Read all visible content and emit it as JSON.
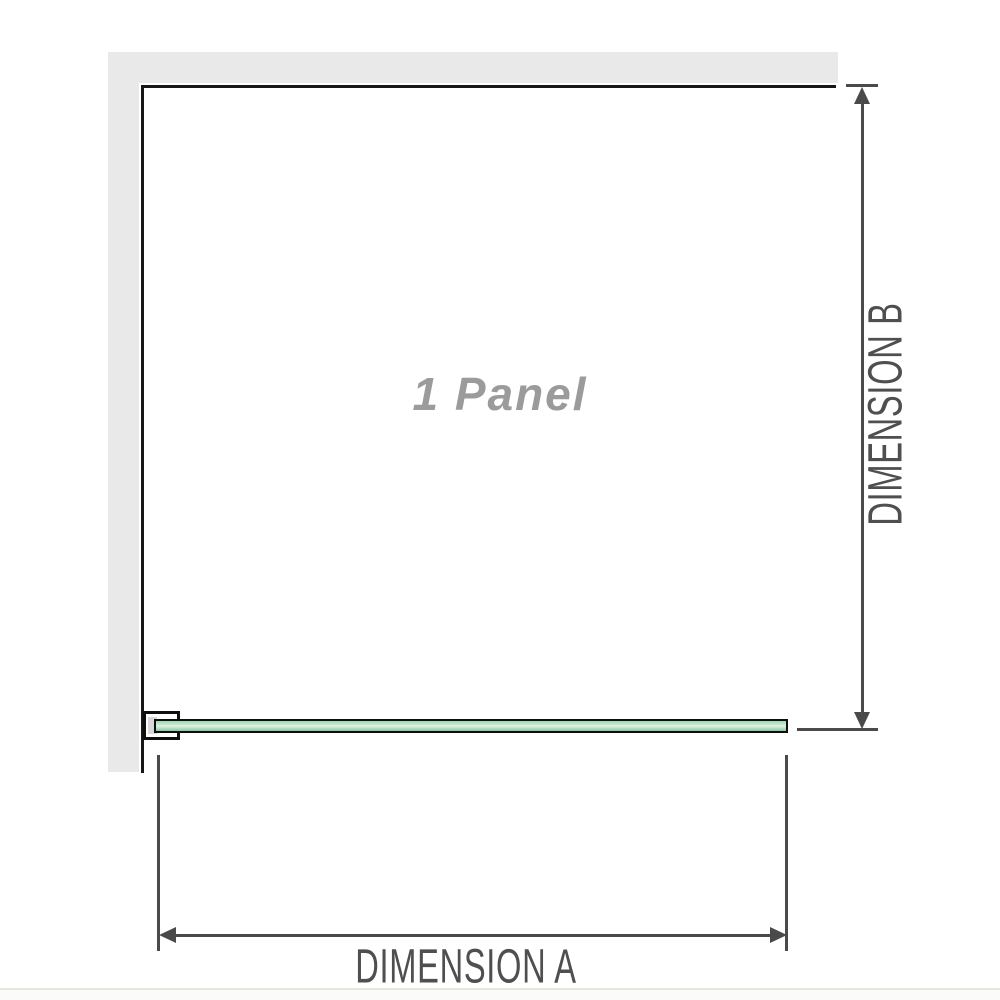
{
  "diagram": {
    "type": "shower-screen-dimension-diagram",
    "panel": {
      "label": "1 Panel"
    },
    "dimension_a": {
      "label": "DIMENSION A",
      "orientation": "horizontal"
    },
    "dimension_b": {
      "label": "DIMENSION B",
      "orientation": "vertical"
    },
    "icons": {
      "arrow_up": "filled triangle pointing up",
      "arrow_down": "filled triangle pointing down",
      "arrow_left": "filled triangle pointing left",
      "arrow_right": "filled triangle pointing right"
    },
    "colors": {
      "wall_gray": "#e9e9e9",
      "outline_black": "#171717",
      "glass_green": "#a8dab8",
      "glass_highlight": "#def1e4",
      "dimension_gray": "#4a4a4a",
      "panel_label_gray": "#9b9b9b",
      "bracket_pad_gray": "#d8d8d8",
      "background": "#ffffff"
    }
  }
}
